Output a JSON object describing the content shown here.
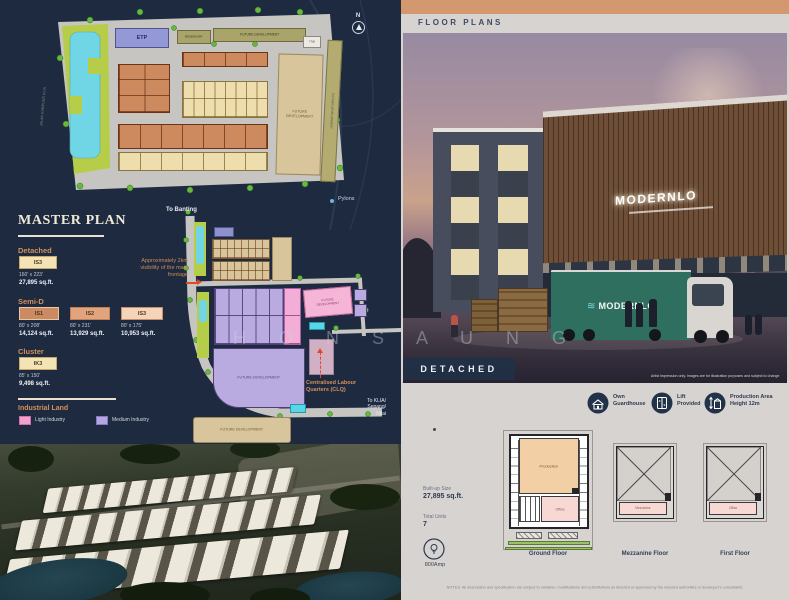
{
  "watermark": "H O N S A U N G",
  "map1": {
    "etp": "ETP",
    "reservoir": "RESERVOIR",
    "future_top": "FUTURE DEVELOPMENT",
    "future_tall": "FUTURE\nDEVELOPMENT",
    "road_strip": "FUTURE DEVELOPMENT",
    "tnb": "TNB",
    "road_left": "JALAN KAMPUNG KLIA",
    "compass_n": "N",
    "pylons": "Pylons"
  },
  "legend": {
    "title": "MASTER PLAN",
    "detached_heading": "Detached",
    "detached_code": "IS3",
    "detached_dims": "160' x 223'",
    "detached_area": "27,895 sq.ft.",
    "semid_heading": "Semi-D",
    "semid": [
      {
        "code": "IS1",
        "dims": "80' x 208'",
        "area": "14,124 sq.ft."
      },
      {
        "code": "IS2",
        "dims": "80' x 231'",
        "area": "13,929 sq.ft."
      },
      {
        "code": "IS3",
        "dims": "80' x 175'",
        "area": "10,953 sq.ft."
      }
    ],
    "cluster_heading": "Cluster",
    "cluster_code": "IK3",
    "cluster_dims": "85' x 150'",
    "cluster_area": "9,498 sq.ft.",
    "industrial_heading": "Industrial Land",
    "light_label": "Light Industry",
    "medium_label": "Medium Industry",
    "light_color": "#f2a0cc",
    "medium_color": "#b4a6de"
  },
  "map2": {
    "to_banting": "To Banting",
    "visibility": "Approximately 2km\nvisibility of the main\nfrontage",
    "future_pink": "FUTURE\nDEVELOPMENT",
    "future_big": "FUTURE DEVELOPMENT",
    "future_bottom": "FUTURE DEVELOPMENT",
    "clq": "Centralised Labour\nQuarters (CLQ)",
    "to_klia": "To KLIA/\nSepang/\nNilai"
  },
  "floorplans": {
    "header": "FLOOR PLANS",
    "badge": "DETACHED",
    "sign": "MODERNLO",
    "truck": "MODERNLO",
    "caption": "Artist impression only. Images are for illustration purposes and subject to change",
    "features": [
      {
        "label": "Own\nGuardhouse"
      },
      {
        "label": "Lift\nProvided"
      },
      {
        "label": "Production Area\nHeight 12m"
      }
    ],
    "built_label": "Built-up Size",
    "built_value": "27,895 sq.ft.",
    "units_label": "Total Units",
    "units_value": "7",
    "amp": "800Amp",
    "plans": [
      {
        "name": "Ground Floor",
        "room": "Production",
        "room2": "Office"
      },
      {
        "name": "Mezzanine Floor",
        "room": "Mezzanine"
      },
      {
        "name": "First Floor",
        "room": "Office"
      }
    ],
    "note": "NOTES: All description and specification are subject to variation, modifications and substitutions as directed or approved by the relevant authorities or developer's consultants."
  },
  "colors": {
    "navy": "#1e2a40",
    "gold": "#d2905a",
    "panel_gray": "#d7d3d0",
    "orange_bar": "#d3986e"
  }
}
